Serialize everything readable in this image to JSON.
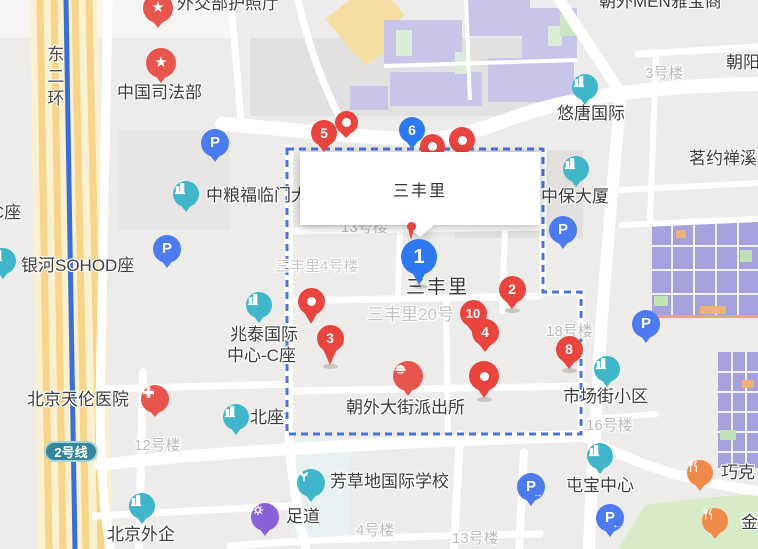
{
  "map": {
    "info_box": {
      "text": "三丰里",
      "x": 300,
      "y": 152,
      "width": 240,
      "height": 73
    },
    "badge": {
      "text": "2号线"
    },
    "boundary": {
      "points": "287,149 543,149 543,292 581,292 581,434 287,434"
    },
    "palette": {
      "marker_red": "#E9453E",
      "marker_blue": "#2E78F2",
      "poi_teal": "#3FB6C9",
      "poi_parking_blue": "#4C7BEF",
      "poi_red": "#E8554C",
      "poi_orange": "#F08A4B",
      "poi_purple": "#8A62D8",
      "boundary_blue": "#4A73DC",
      "subway_line_blue": "#3A6ED9",
      "highway_yellow": "#F6D489",
      "badge_teal": "#33869B",
      "park_green": "#D7EBC9",
      "building_lavender": "#C9C5E9",
      "building_indigo": "#A6A1DC"
    },
    "labels": [
      {
        "t": "外交部护照厅",
        "x": 177,
        "y": -5,
        "cls": "dark"
      },
      {
        "t": "朝外MEN雅宝商",
        "x": 599,
        "y": -7,
        "cls": "dark"
      },
      {
        "t": "中国司法部",
        "x": 117,
        "y": 84,
        "cls": "dark"
      },
      {
        "t": "朝阳",
        "x": 726,
        "y": 54,
        "cls": "dark"
      },
      {
        "t": "3号楼",
        "x": 645,
        "y": 66,
        "cls": "gray"
      },
      {
        "t": "悠唐国际",
        "x": 557,
        "y": 105,
        "cls": "dark"
      },
      {
        "t": "茗约禅溪",
        "x": 689,
        "y": 150,
        "cls": "dark"
      },
      {
        "t": "中保大厦",
        "x": 541,
        "y": 188,
        "cls": "dark"
      },
      {
        "t": "中粮福临门大厦",
        "x": 206,
        "y": 187,
        "cls": "dark"
      },
      {
        "t": "C座",
        "x": -8,
        "y": 204,
        "cls": "dark"
      },
      {
        "t": "银河SOHOD座",
        "x": 21,
        "y": 257,
        "cls": "dark"
      },
      {
        "t": "兆泰国际",
        "x": 230,
        "y": 326,
        "cls": "dark"
      },
      {
        "t": "中心-C座",
        "x": 227,
        "y": 347,
        "cls": "dark"
      },
      {
        "t": "三丰里",
        "x": 406,
        "y": 278,
        "cls": "big"
      },
      {
        "t": "三丰里20号",
        "x": 367,
        "y": 306,
        "cls": "lightg"
      },
      {
        "t": "三丰里4号楼",
        "x": 275,
        "y": 259,
        "cls": "lightg15"
      },
      {
        "t": "13号楼",
        "x": 341,
        "y": 220,
        "cls": "gray"
      },
      {
        "t": "12号楼",
        "x": 134,
        "y": 438,
        "cls": "gray"
      },
      {
        "t": "16号楼",
        "x": 586,
        "y": 418,
        "cls": "gray"
      },
      {
        "t": "18号楼",
        "x": 546,
        "y": 324,
        "cls": "gray"
      },
      {
        "t": "4号楼",
        "x": 356,
        "y": 523,
        "cls": "gray"
      },
      {
        "t": "13号楼",
        "x": 452,
        "y": 531,
        "cls": "gray"
      },
      {
        "t": "北京天伦医院",
        "x": 27,
        "y": 391,
        "cls": "dark"
      },
      {
        "t": "北座",
        "x": 250,
        "y": 409,
        "cls": "dark"
      },
      {
        "t": "朝外大街派出所",
        "x": 346,
        "y": 399,
        "cls": "dark"
      },
      {
        "t": "市场街小区",
        "x": 563,
        "y": 388,
        "cls": "dark"
      },
      {
        "t": "屯宝中心",
        "x": 566,
        "y": 477,
        "cls": "dark"
      },
      {
        "t": "芳草地国际学校",
        "x": 330,
        "y": 473,
        "cls": "dark"
      },
      {
        "t": "足道",
        "x": 286,
        "y": 508,
        "cls": "dark"
      },
      {
        "t": "北京外企",
        "x": 107,
        "y": 526,
        "cls": "dark"
      },
      {
        "t": "巧克",
        "x": 721,
        "y": 464,
        "cls": "dark"
      },
      {
        "t": "金",
        "x": 741,
        "y": 514,
        "cls": "dark"
      },
      {
        "t": "东二环",
        "x": 44,
        "y": 45,
        "cls": "vert"
      }
    ],
    "markers_before_infobox": [
      {
        "n": "5",
        "color": "red",
        "x": 324,
        "y": 133,
        "d": 26
      },
      {
        "dot": true,
        "color": "red",
        "x": 346,
        "y": 122,
        "d": 23,
        "tail": 7
      },
      {
        "n": "6",
        "color": "blue",
        "x": 412,
        "y": 130,
        "d": 26
      },
      {
        "dot": true,
        "color": "red",
        "x": 432,
        "y": 146,
        "d": 25
      },
      {
        "dot": true,
        "color": "red",
        "x": 462,
        "y": 140,
        "d": 26
      }
    ],
    "markers_after_infobox": [
      {
        "dot": true,
        "color": "red",
        "x": 311,
        "y": 301,
        "d": 27,
        "tail": 12
      },
      {
        "n": "3",
        "color": "red",
        "x": 330,
        "y": 338,
        "d": 27,
        "tail": 16,
        "shadow": true
      },
      {
        "n": "2",
        "color": "red",
        "x": 512,
        "y": 289,
        "d": 27,
        "tail": 9,
        "shadow": true
      },
      {
        "n": "10",
        "color": "red",
        "x": 473,
        "y": 313,
        "d": 27,
        "fs": 13
      },
      {
        "n": "4",
        "color": "red",
        "x": 485,
        "y": 332,
        "d": 27
      },
      {
        "dot": true,
        "color": "red",
        "x": 484,
        "y": 376,
        "d": 30,
        "tail": 10,
        "shadow": true
      },
      {
        "n": "8",
        "color": "red",
        "x": 569,
        "y": 349,
        "d": 27,
        "tail": 9,
        "shadow": true
      },
      {
        "thin": true,
        "color": "red",
        "x": 411,
        "y": 226,
        "d": 9
      },
      {
        "n": "1",
        "color": "blue",
        "x": 419,
        "y": 257,
        "d": 36,
        "fs": 20,
        "tail": 13,
        "shadow": true
      }
    ],
    "pois": [
      {
        "type": "star",
        "x": 158,
        "y": 8,
        "d": 30
      },
      {
        "type": "star",
        "x": 161,
        "y": 63,
        "d": 30
      },
      {
        "type": "parking",
        "x": 215,
        "y": 143,
        "d": 28
      },
      {
        "type": "building",
        "x": 186,
        "y": 194,
        "d": 26
      },
      {
        "type": "building",
        "x": 3,
        "y": 261,
        "d": 26
      },
      {
        "type": "parking",
        "x": 167,
        "y": 249,
        "d": 28
      },
      {
        "type": "building",
        "x": 259,
        "y": 305,
        "d": 26
      },
      {
        "type": "building",
        "x": 585,
        "y": 87,
        "d": 26
      },
      {
        "type": "building",
        "x": 576,
        "y": 169,
        "d": 26
      },
      {
        "type": "parking",
        "x": 563,
        "y": 230,
        "d": 28
      },
      {
        "type": "hospital",
        "x": 155,
        "y": 399,
        "d": 28,
        "tail": 7
      },
      {
        "type": "building",
        "x": 236,
        "y": 417,
        "d": 26
      },
      {
        "type": "police",
        "x": 408,
        "y": 376,
        "d": 30
      },
      {
        "type": "building",
        "x": 607,
        "y": 369,
        "d": 26
      },
      {
        "type": "parking",
        "x": 646,
        "y": 324,
        "d": 28
      },
      {
        "type": "building",
        "x": 600,
        "y": 456,
        "d": 26
      },
      {
        "type": "parking-right",
        "x": 531,
        "y": 487,
        "d": 28
      },
      {
        "type": "parking-left",
        "x": 610,
        "y": 518,
        "d": 28
      },
      {
        "type": "restaurant",
        "x": 700,
        "y": 473,
        "d": 26
      },
      {
        "type": "restaurant",
        "x": 715,
        "y": 521,
        "d": 26
      },
      {
        "type": "school",
        "x": 311,
        "y": 483,
        "d": 28
      },
      {
        "type": "massage",
        "x": 265,
        "y": 517,
        "d": 28
      },
      {
        "type": "building",
        "x": 142,
        "y": 506,
        "d": 26
      }
    ]
  }
}
